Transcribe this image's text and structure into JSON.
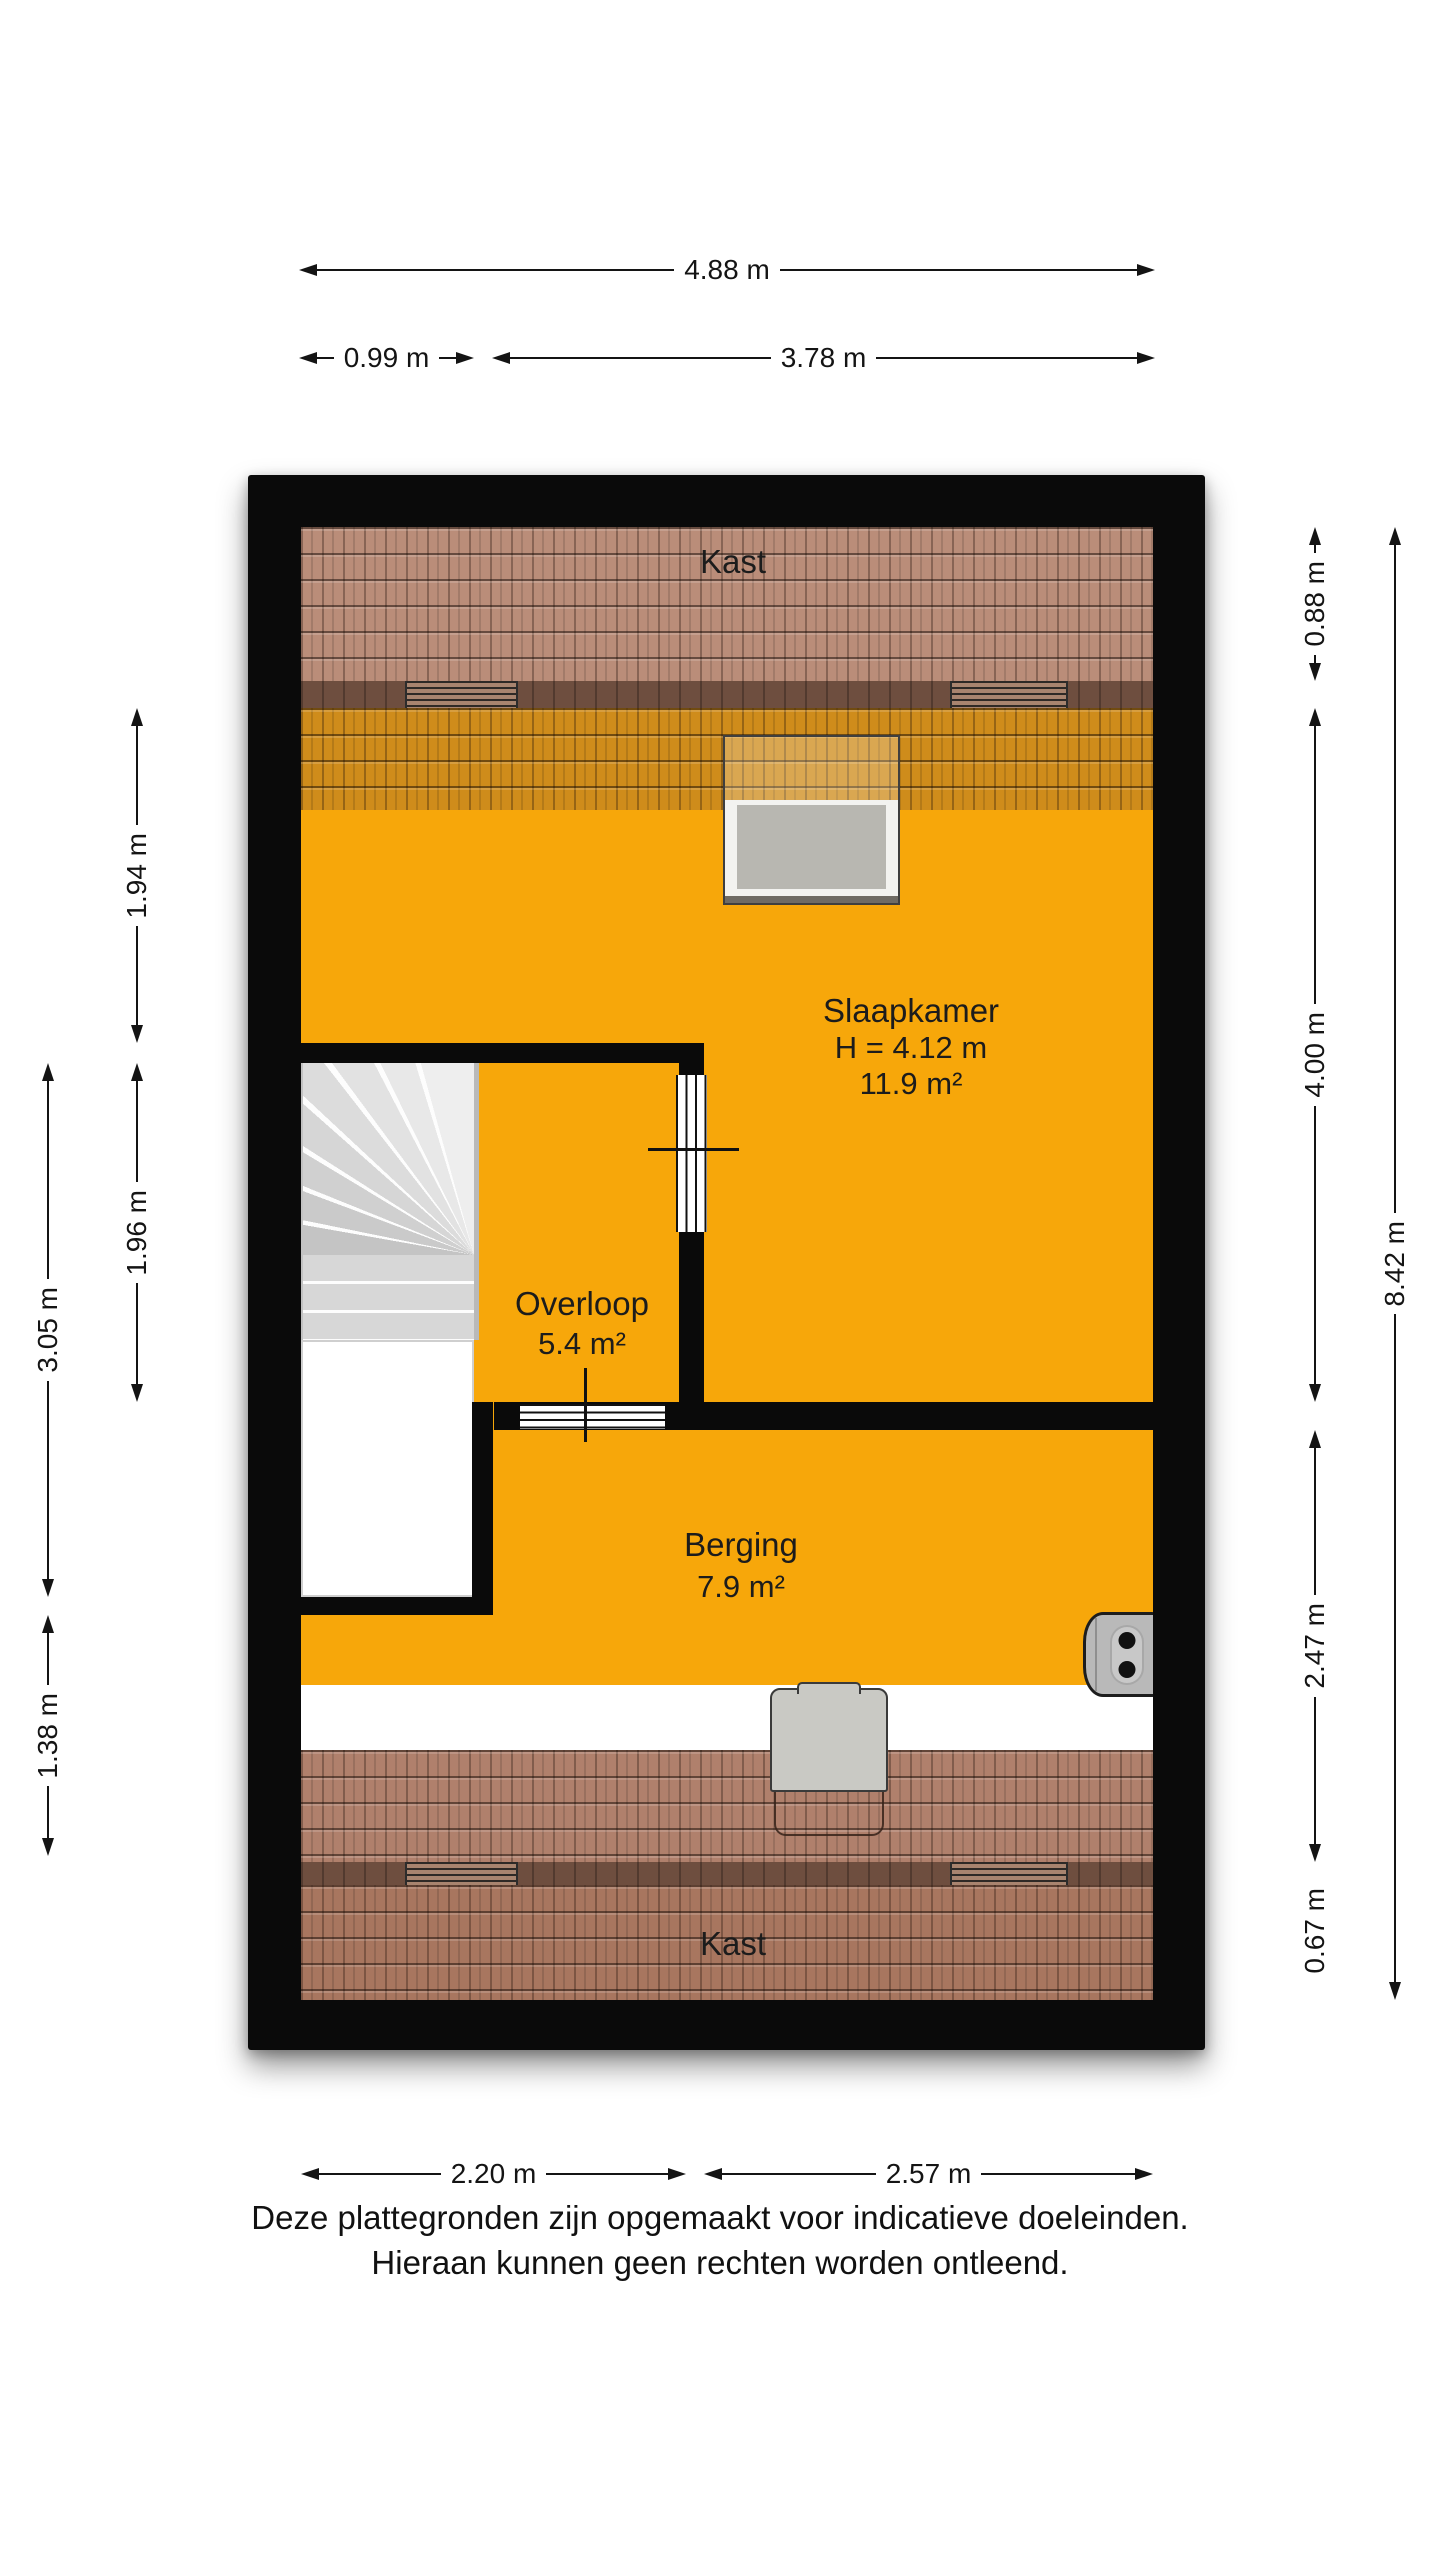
{
  "plan": {
    "rooms": {
      "kast_top": {
        "label": "Kast"
      },
      "slaapkamer": {
        "label": "Slaapkamer",
        "height": "H = 4.12 m",
        "area": "11.9 m²"
      },
      "overloop": {
        "label": "Overloop",
        "area": "5.4 m²"
      },
      "berging": {
        "label": "Berging",
        "area": "7.9 m²"
      },
      "kast_bottom": {
        "label": "Kast"
      }
    }
  },
  "dimensions": {
    "top_total": "4.88 m",
    "top_left": "0.99 m",
    "top_right": "3.78 m",
    "left_inner_top": "1.94 m",
    "left_inner_bottom": "1.96 m",
    "left_outer_top": "3.05 m",
    "left_outer_bottom": "1.38 m",
    "right_inner_kast_top": "0.88 m",
    "right_inner_slaapkamer": "4.00 m",
    "right_inner_berging": "2.47 m",
    "right_inner_kast_bottom": "0.67 m",
    "right_outer": "8.42 m",
    "bottom_left": "2.20 m",
    "bottom_right": "2.57 m"
  },
  "footer": {
    "line1": "Deze plattegronden zijn opgemaakt voor indicatieve doeleinden.",
    "line2": "Hieraan kunnen geen rechten worden ontleend."
  },
  "colors": {
    "room_accent_orange": "#f7a70a",
    "berging_floor_cream": "#f1ebd5",
    "roof_tile_salmon": "#ba8d79",
    "roof_tile_orange": "#cf8c1b",
    "roof_tile_red": "#a8765f",
    "knee_wall_brown": "#6e4e3f",
    "wall_black": "#0a0a0a"
  }
}
